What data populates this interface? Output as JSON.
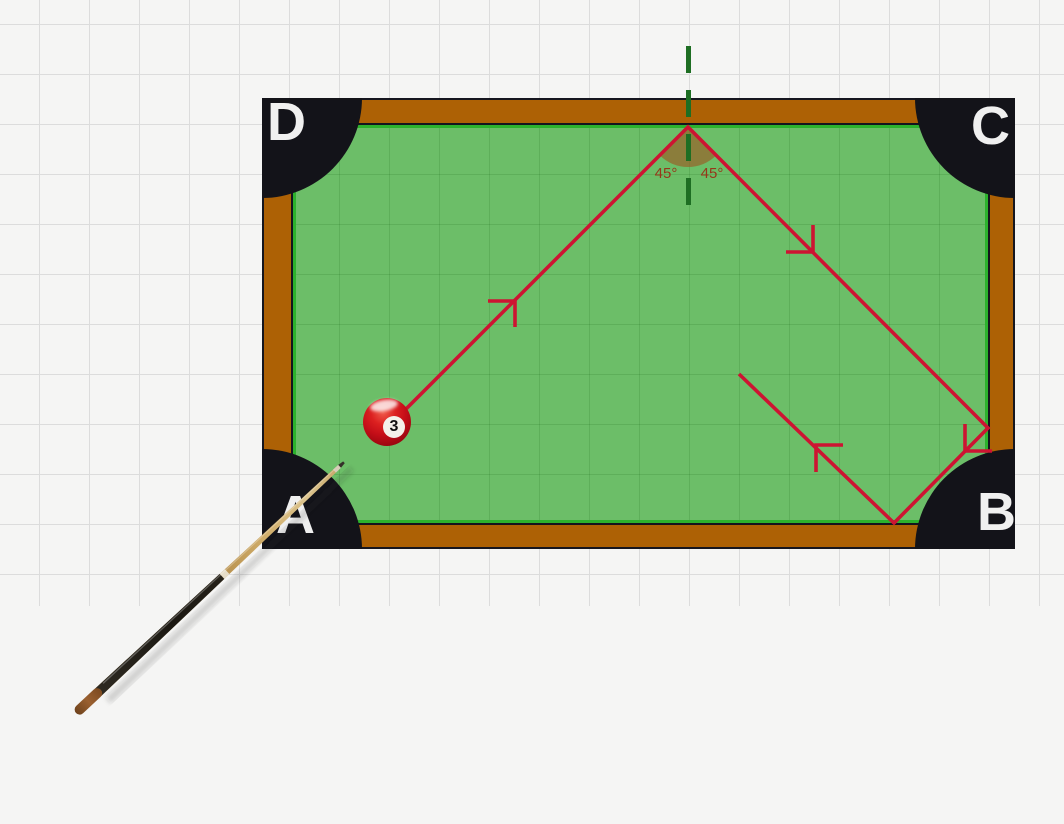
{
  "diagram": {
    "type": "billiard-table-reflection-diagram",
    "corner_labels": {
      "top_left": "D",
      "top_right": "C",
      "bottom_left": "A",
      "bottom_right": "B"
    },
    "angle_labels": {
      "left": "45°",
      "right": "45°"
    },
    "ball": {
      "number": "3"
    },
    "colors": {
      "background": "#f5f5f4",
      "grid_line": "#dcdcdc",
      "rail": "#ad6105",
      "felt": "#6cbe68",
      "cushion_line": "#2cb22d",
      "pocket": "#131319",
      "corner_label_text": "#f0f0f0",
      "path": "#cd1432",
      "normal": "#1e6e23",
      "angle_text": "#96371a",
      "wedge_fill": "rgba(160,82,30,0.6)",
      "ball": "#c40e18"
    },
    "trajectory": {
      "points": [
        [
          391,
          424
        ],
        [
          688,
          127
        ],
        [
          988,
          428
        ],
        [
          894,
          523
        ],
        [
          739,
          374
        ]
      ],
      "arrows": [
        {
          "tip": [
            515,
            301
          ],
          "legs": [
            [
              -27,
              0
            ],
            [
              0,
              26
            ]
          ]
        },
        {
          "tip": [
            813,
            252
          ],
          "legs": [
            [
              0,
              -27
            ],
            [
              -27,
              0
            ]
          ]
        },
        {
          "tip": [
            965,
            451
          ],
          "legs": [
            [
              0,
              -27
            ],
            [
              27,
              0
            ]
          ]
        },
        {
          "tip": [
            816,
            445
          ],
          "legs": [
            [
              27,
              0
            ],
            [
              0,
              27
            ]
          ]
        }
      ]
    },
    "normal_line": {
      "x": 688.5,
      "y_top": 46,
      "y_bottom": 222,
      "dash": "27 17"
    },
    "angle_wedge": {
      "center": [
        688,
        127
      ],
      "radius": 40,
      "from_deg": 45,
      "to_deg": 135
    }
  }
}
